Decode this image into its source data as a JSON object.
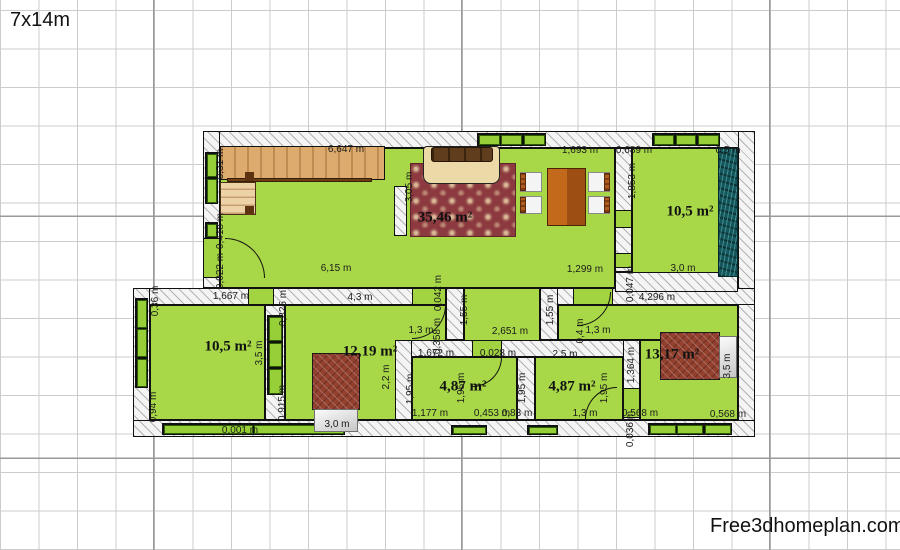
{
  "title": "7x14m",
  "watermark": "Free3dhomeplan.com",
  "colors": {
    "room_green": "#a8d848",
    "window_green": "#96cf37",
    "carpet_red": "#8c3a40",
    "wood_tan": "#dcab6d",
    "teal_wardrobe": "#14565c",
    "bed_maroon": "#93402f",
    "grid_line": "#cccccc"
  },
  "plan": {
    "rooms": [
      {
        "x": 220,
        "y": 148,
        "w": 395,
        "h": 140
      },
      {
        "x": 632,
        "y": 148,
        "w": 106,
        "h": 129
      },
      {
        "x": 150,
        "y": 305,
        "w": 115,
        "h": 115
      },
      {
        "x": 285,
        "y": 305,
        "w": 161,
        "h": 115
      },
      {
        "x": 464,
        "y": 288,
        "w": 76,
        "h": 69
      },
      {
        "x": 412,
        "y": 357,
        "w": 105,
        "h": 63
      },
      {
        "x": 535,
        "y": 357,
        "w": 88,
        "h": 63
      },
      {
        "x": 558,
        "y": 305,
        "w": 180,
        "h": 35
      },
      {
        "x": 640,
        "y": 340,
        "w": 98,
        "h": 80
      }
    ],
    "walls": [
      {
        "x": 203,
        "y": 131,
        "w": 552,
        "h": 17
      },
      {
        "x": 203,
        "y": 131,
        "w": 17,
        "h": 157
      },
      {
        "x": 738,
        "y": 131,
        "w": 17,
        "h": 306
      },
      {
        "x": 133,
        "y": 288,
        "w": 322,
        "h": 17
      },
      {
        "x": 557,
        "y": 288,
        "w": 198,
        "h": 17
      },
      {
        "x": 133,
        "y": 288,
        "w": 17,
        "h": 149
      },
      {
        "x": 133,
        "y": 420,
        "w": 622,
        "h": 17
      },
      {
        "x": 615,
        "y": 148,
        "w": 17,
        "h": 124
      },
      {
        "x": 615,
        "y": 272,
        "w": 123,
        "h": 20
      },
      {
        "x": 446,
        "y": 288,
        "w": 18,
        "h": 52
      },
      {
        "x": 540,
        "y": 288,
        "w": 18,
        "h": 52
      },
      {
        "x": 395,
        "y": 340,
        "w": 245,
        "h": 17
      },
      {
        "x": 395,
        "y": 340,
        "w": 17,
        "h": 80
      },
      {
        "x": 517,
        "y": 357,
        "w": 18,
        "h": 63
      },
      {
        "x": 623,
        "y": 340,
        "w": 17,
        "h": 80
      },
      {
        "x": 265,
        "y": 305,
        "w": 20,
        "h": 115
      },
      {
        "x": 394,
        "y": 186,
        "w": 13,
        "h": 50
      }
    ],
    "sills": [
      {
        "x": 248,
        "y": 288,
        "w": 26,
        "h": 17
      },
      {
        "x": 412,
        "y": 288,
        "w": 34,
        "h": 17
      },
      {
        "x": 573,
        "y": 288,
        "w": 40,
        "h": 17
      },
      {
        "x": 615,
        "y": 210,
        "w": 17,
        "h": 18
      },
      {
        "x": 615,
        "y": 253,
        "w": 17,
        "h": 15
      },
      {
        "x": 472,
        "y": 340,
        "w": 30,
        "h": 17
      },
      {
        "x": 623,
        "y": 388,
        "w": 17,
        "h": 30
      },
      {
        "x": 203,
        "y": 238,
        "w": 17,
        "h": 40
      }
    ],
    "windows": [
      {
        "x": 477,
        "y": 133,
        "w": 69,
        "h": 13,
        "p": 3,
        "o": "row"
      },
      {
        "x": 652,
        "y": 133,
        "w": 68,
        "h": 13,
        "p": 3,
        "o": "row"
      },
      {
        "x": 205,
        "y": 152,
        "w": 13,
        "h": 52,
        "p": 2,
        "o": "col"
      },
      {
        "x": 205,
        "y": 222,
        "w": 13,
        "h": 16,
        "p": 1,
        "o": "col"
      },
      {
        "x": 135,
        "y": 298,
        "w": 13,
        "h": 90,
        "p": 3,
        "o": "col"
      },
      {
        "x": 267,
        "y": 315,
        "w": 16,
        "h": 80,
        "p": 3,
        "o": "col"
      },
      {
        "x": 162,
        "y": 423,
        "w": 183,
        "h": 12,
        "p": 2,
        "o": "row"
      },
      {
        "x": 451,
        "y": 425,
        "w": 36,
        "h": 10,
        "p": 1,
        "o": "row"
      },
      {
        "x": 527,
        "y": 425,
        "w": 31,
        "h": 10,
        "p": 1,
        "o": "row"
      },
      {
        "x": 648,
        "y": 423,
        "w": 84,
        "h": 12,
        "p": 3,
        "o": "row"
      }
    ],
    "doors": [
      {
        "x": 225,
        "y": 238,
        "s": 40,
        "q": "tr"
      },
      {
        "x": 577,
        "y": 292,
        "s": 34,
        "q": "br"
      },
      {
        "x": 412,
        "y": 305,
        "s": 34,
        "q": "br"
      },
      {
        "x": 472,
        "y": 357,
        "s": 30,
        "q": "br"
      },
      {
        "x": 585,
        "y": 387,
        "s": 32,
        "q": "tl"
      }
    ],
    "furniture": [
      {
        "k": "stairs-upper",
        "x": 220,
        "y": 146,
        "w": 165,
        "h": 34
      },
      {
        "k": "rail",
        "x": 227,
        "y": 178,
        "w": 145,
        "h": 4
      },
      {
        "k": "stairs-lower",
        "x": 220,
        "y": 182,
        "w": 36,
        "h": 33
      },
      {
        "k": "post",
        "x": 245,
        "y": 172,
        "w": 9,
        "h": 9
      },
      {
        "k": "post",
        "x": 245,
        "y": 206,
        "w": 9,
        "h": 9
      },
      {
        "k": "carpet",
        "x": 410,
        "y": 163,
        "w": 106,
        "h": 74
      },
      {
        "k": "sofa-body",
        "x": 423,
        "y": 146,
        "w": 77,
        "h": 38
      },
      {
        "k": "sofa-back",
        "x": 431,
        "y": 147,
        "w": 62,
        "h": 15
      },
      {
        "k": "table",
        "x": 547,
        "y": 168,
        "w": 39,
        "h": 58
      },
      {
        "k": "chair",
        "x": 520,
        "y": 172,
        "w": 22,
        "h": 20,
        "side": "left"
      },
      {
        "k": "chair",
        "x": 520,
        "y": 196,
        "w": 22,
        "h": 18,
        "side": "left"
      },
      {
        "k": "chair",
        "x": 588,
        "y": 172,
        "w": 22,
        "h": 20,
        "side": "right"
      },
      {
        "k": "chair",
        "x": 588,
        "y": 196,
        "w": 22,
        "h": 18,
        "side": "right"
      },
      {
        "k": "wardrobe",
        "x": 718,
        "y": 148,
        "w": 20,
        "h": 129
      },
      {
        "k": "bed",
        "x": 312,
        "y": 353,
        "w": 48,
        "h": 57
      },
      {
        "k": "pillow",
        "x": 314,
        "y": 409,
        "w": 44,
        "h": 23
      },
      {
        "k": "bed",
        "x": 660,
        "y": 332,
        "w": 60,
        "h": 48
      },
      {
        "k": "pillow",
        "x": 719,
        "y": 336,
        "w": 18,
        "h": 42
      }
    ],
    "area_labels": [
      {
        "text": "35,46 m²",
        "x": 445,
        "y": 218
      },
      {
        "text": "10,5 m²",
        "x": 690,
        "y": 212
      },
      {
        "text": "10,5 m²",
        "x": 228,
        "y": 347
      },
      {
        "text": "12,19 m²",
        "x": 370,
        "y": 352
      },
      {
        "text": "4,87 m²",
        "x": 463,
        "y": 387
      },
      {
        "text": "4,87 m²",
        "x": 572,
        "y": 387
      },
      {
        "text": "13,17 m²",
        "x": 672,
        "y": 355
      }
    ],
    "dimension_labels": [
      {
        "text": "6,647 m",
        "x": 346,
        "y": 150
      },
      {
        "text": "0,31 m",
        "x": 221,
        "y": 164,
        "rot": true
      },
      {
        "text": "1,693 m",
        "x": 580,
        "y": 151
      },
      {
        "text": "0,689 m",
        "x": 634,
        "y": 151
      },
      {
        "text": "0,5 m",
        "x": 728,
        "y": 151
      },
      {
        "text": "1,853 m",
        "x": 633,
        "y": 181,
        "rot": true
      },
      {
        "text": "3,05 m",
        "x": 410,
        "y": 187,
        "rot": true
      },
      {
        "text": "0,418 m",
        "x": 221,
        "y": 231,
        "rot": true
      },
      {
        "text": "0,022 m",
        "x": 221,
        "y": 271,
        "rot": true
      },
      {
        "text": "6,15 m",
        "x": 336,
        "y": 269
      },
      {
        "text": "1,299 m",
        "x": 585,
        "y": 270
      },
      {
        "text": "3,0 m",
        "x": 683,
        "y": 269
      },
      {
        "text": "0,047 m",
        "x": 631,
        "y": 284,
        "rot": true
      },
      {
        "text": "1,667 m",
        "x": 231,
        "y": 297
      },
      {
        "text": "0,36 m",
        "x": 156,
        "y": 301,
        "rot": true
      },
      {
        "text": "4,3 m",
        "x": 360,
        "y": 298
      },
      {
        "text": "4,296 m",
        "x": 657,
        "y": 298
      },
      {
        "text": "0,825 m",
        "x": 284,
        "y": 308,
        "rot": true
      },
      {
        "text": "1,55 m",
        "x": 465,
        "y": 310,
        "rot": true
      },
      {
        "text": "1,55 m",
        "x": 551,
        "y": 310,
        "rot": true
      },
      {
        "text": "0,042 m",
        "x": 439,
        "y": 293,
        "rot": true
      },
      {
        "text": "1,3 m",
        "x": 421,
        "y": 331
      },
      {
        "text": "0,358 m",
        "x": 438,
        "y": 336,
        "rot": true
      },
      {
        "text": "2,651 m",
        "x": 510,
        "y": 332
      },
      {
        "text": "0,4 m",
        "x": 581,
        "y": 331,
        "rot": true
      },
      {
        "text": "1,3 m",
        "x": 598,
        "y": 331
      },
      {
        "text": "3,5 m",
        "x": 260,
        "y": 353,
        "rot": true
      },
      {
        "text": "1,672 m",
        "x": 436,
        "y": 354
      },
      {
        "text": "0,028 m",
        "x": 498,
        "y": 354
      },
      {
        "text": "2,5 m",
        "x": 565,
        "y": 355
      },
      {
        "text": "1,364 m",
        "x": 632,
        "y": 365,
        "rot": true
      },
      {
        "text": "2,2 m",
        "x": 387,
        "y": 377,
        "rot": true
      },
      {
        "text": "1,95 m",
        "x": 411,
        "y": 389,
        "rot": true
      },
      {
        "text": "1,95 m",
        "x": 462,
        "y": 388,
        "rot": true
      },
      {
        "text": "1,95 m",
        "x": 523,
        "y": 388,
        "rot": true
      },
      {
        "text": "1,95 m",
        "x": 605,
        "y": 388,
        "rot": true
      },
      {
        "text": "3,5 m",
        "x": 728,
        "y": 366,
        "rot": true
      },
      {
        "text": "0,915 m",
        "x": 283,
        "y": 403,
        "rot": true
      },
      {
        "text": "0,94 m",
        "x": 154,
        "y": 407,
        "rot": true
      },
      {
        "text": "3,0 m",
        "x": 337,
        "y": 425
      },
      {
        "text": "1,177 m",
        "x": 430,
        "y": 414
      },
      {
        "text": "0,453 m",
        "x": 492,
        "y": 414
      },
      {
        "text": "0,83 m",
        "x": 517,
        "y": 414
      },
      {
        "text": "1,3 m",
        "x": 585,
        "y": 414
      },
      {
        "text": "0,568 m",
        "x": 640,
        "y": 414
      },
      {
        "text": "0,568 m",
        "x": 728,
        "y": 415
      },
      {
        "text": "0,001 m",
        "x": 240,
        "y": 431
      },
      {
        "text": "0,036 m",
        "x": 631,
        "y": 429,
        "rot": true
      }
    ]
  }
}
